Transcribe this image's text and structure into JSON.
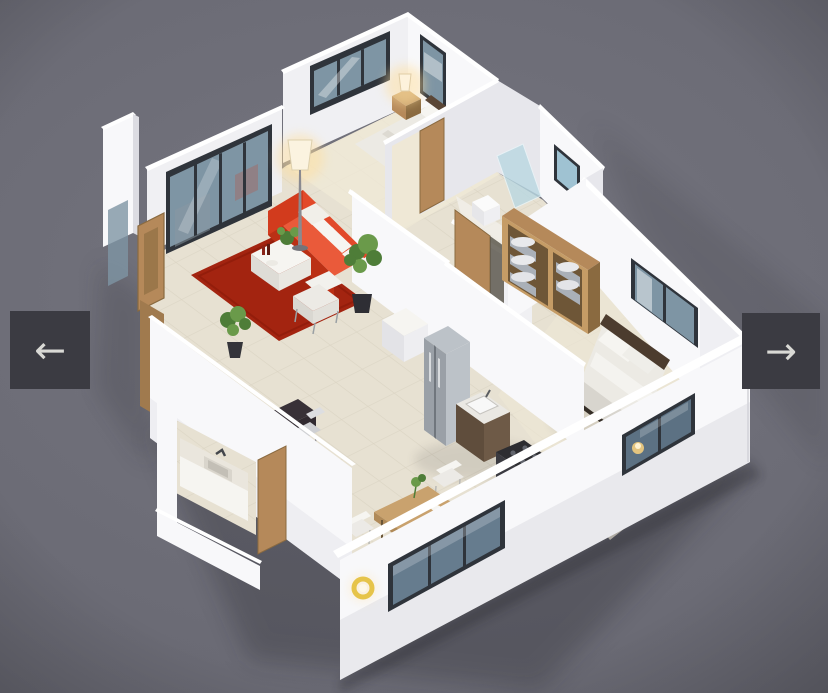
{
  "viewer": {
    "type": "image-carousel",
    "content": "3d-isometric-floorplan-render",
    "prev_button": {
      "icon": "arrow-left-icon",
      "glyph": "←"
    },
    "next_button": {
      "icon": "arrow-right-icon",
      "glyph": "→"
    }
  },
  "scene": {
    "style": "dollhouse cutaway render, white walls, beige tile floors, gray backdrop",
    "rooms": [
      {
        "name": "living-room",
        "items": [
          "red-sofa",
          "red-rug",
          "white-coffee-table",
          "white-armchair",
          "floor-lamp",
          "potted-plants",
          "glass-sliding-doors",
          "dark-desk-with-chair"
        ]
      },
      {
        "name": "bedroom-1",
        "items": [
          "double-bed",
          "dark-headboard",
          "nightstand",
          "lit-table-lamp",
          "two-windows"
        ]
      },
      {
        "name": "bathroom",
        "items": [
          "frosted-glass-shower",
          "toilet",
          "window"
        ]
      },
      {
        "name": "hallway",
        "items": [
          "wooden-doors",
          "linen-wardrobe-with-towels",
          "white-cabinet"
        ]
      },
      {
        "name": "bedroom-2",
        "items": [
          "double-bed",
          "pillows",
          "two-windows",
          "lit-lamp-behind-window"
        ]
      },
      {
        "name": "kitchen",
        "items": [
          "stainless-fridge",
          "sink-counter",
          "dark-cooktop",
          "triple-window"
        ]
      },
      {
        "name": "dining-area",
        "items": [
          "wooden-table",
          "white-chairs",
          "yellow-pendant-lamp",
          "small-plant"
        ]
      },
      {
        "name": "powder-room",
        "items": [
          "vanity-counter-sink",
          "wooden-door"
        ]
      },
      {
        "name": "entry",
        "items": [
          "wooden-front-door",
          "glass-sidelight",
          "fin-wall"
        ]
      }
    ]
  },
  "colors": {
    "bg1": "#75757f",
    "bg2": "#63636d",
    "btn": "#3b3b42",
    "btnIcon": "#d9d9d5",
    "wallBright": "#f8f8fa",
    "wallLight": "#f0f0f3",
    "wallMid": "#e7e7ec",
    "wallShade": "#dcdce2",
    "wallTop": "#ffffff",
    "frame": "#2f343b",
    "glass": "#7e95a4",
    "glassFrost": "#b9d8e2",
    "wood": "#b5895a",
    "woodDark": "#8a6a40",
    "tableWood": "#c9a26e",
    "floor": "#e7e1d2",
    "floorLine": "#d2cbb9",
    "white": "#f6f5f1",
    "red": "#e2492a",
    "redMid": "#ea5a3a",
    "redDark": "#bb3015",
    "rug": "#a32410",
    "green": "#4e7d38",
    "greenLight": "#6a9a4a",
    "steel": "#9aa0a7",
    "steelLight": "#bcc2c8",
    "dark": "#2d2d31",
    "warm": "#ffdf9e",
    "duvet": "#eceae4",
    "towel": "#aab0b8",
    "shadowc": "#1c1c22"
  }
}
